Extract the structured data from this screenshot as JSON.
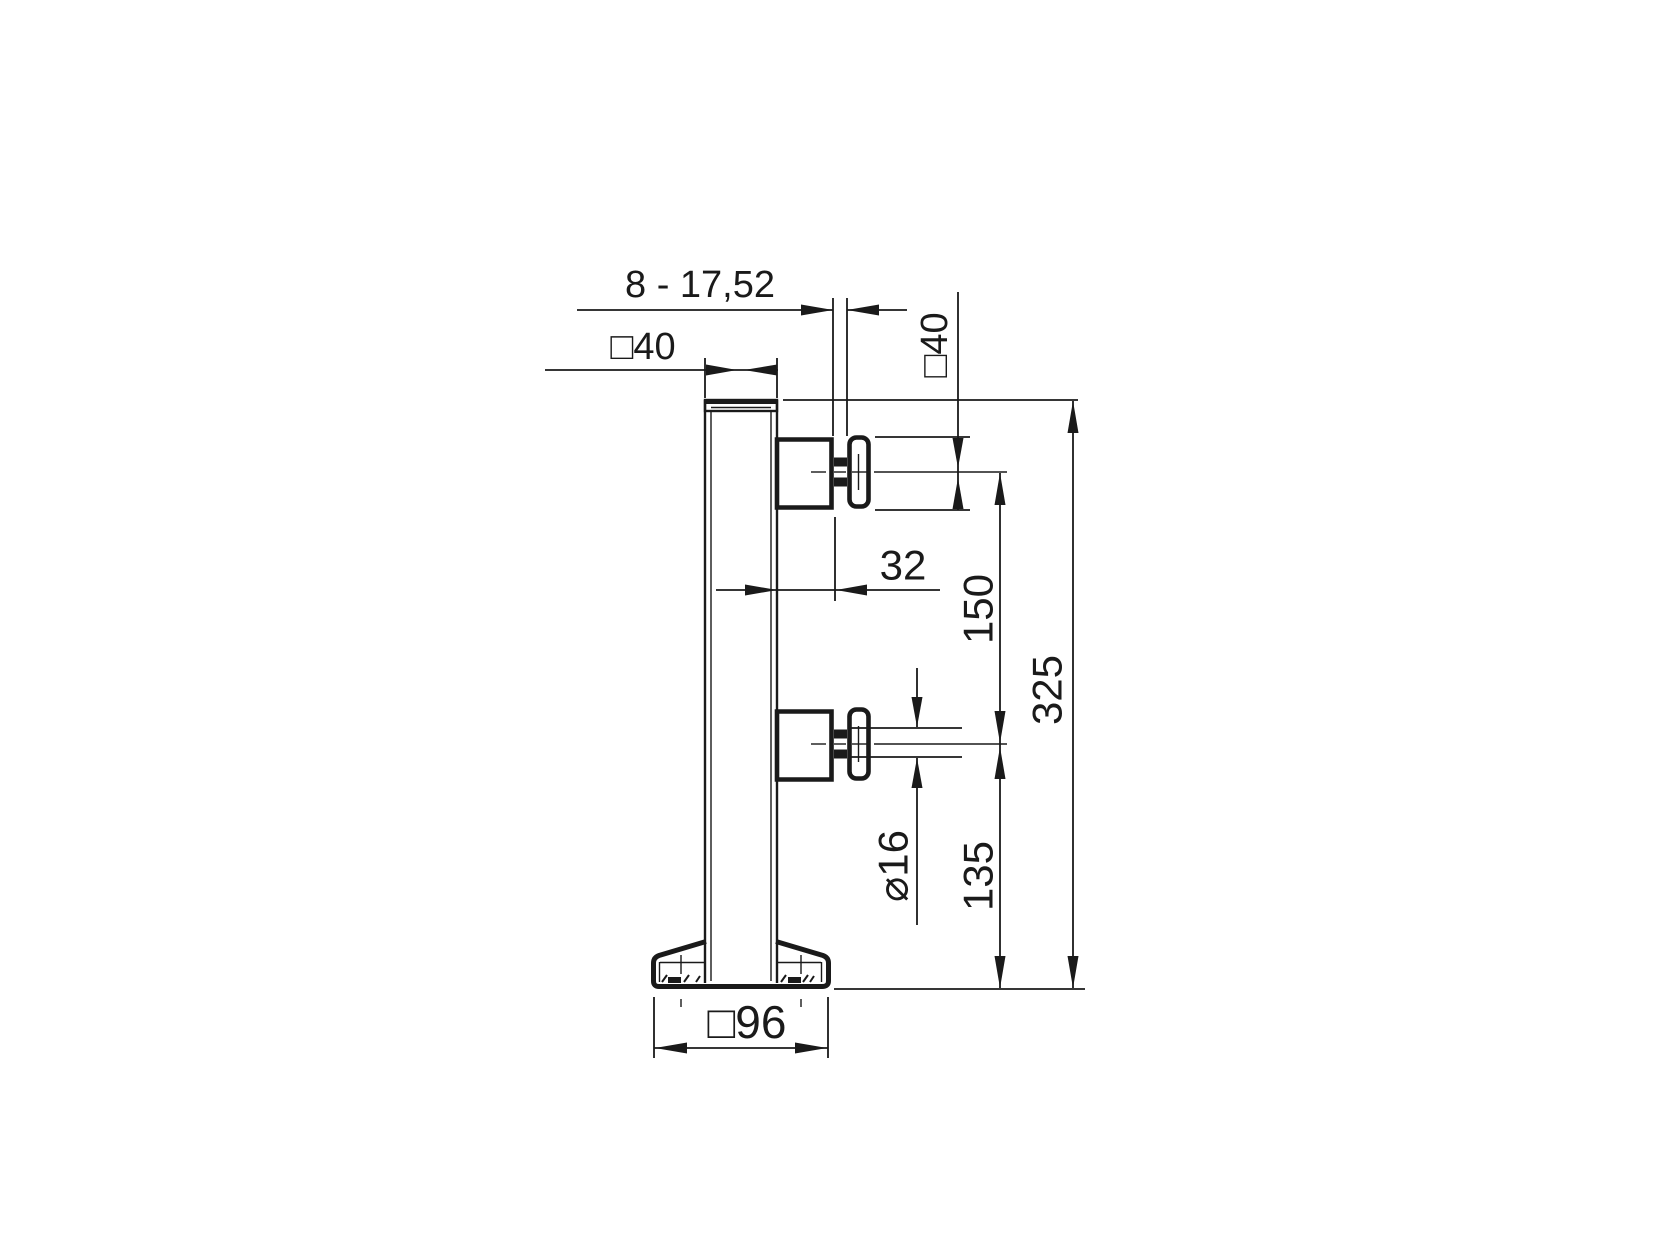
{
  "drawing": {
    "type": "technical-drawing",
    "subject": "glass-clamp-post-side-view",
    "background": "#ffffff",
    "line_color": "#1a1a1a",
    "labels": {
      "glass_thickness_range": "8 - 17,52",
      "post_section": "□40",
      "adapter_size": "□40",
      "post_face_to_glass": "32",
      "point_spacing": "150",
      "total_height": "325",
      "stud_diameter": "⌀16",
      "bottom_point_height": "135",
      "base_size": "□96"
    }
  }
}
